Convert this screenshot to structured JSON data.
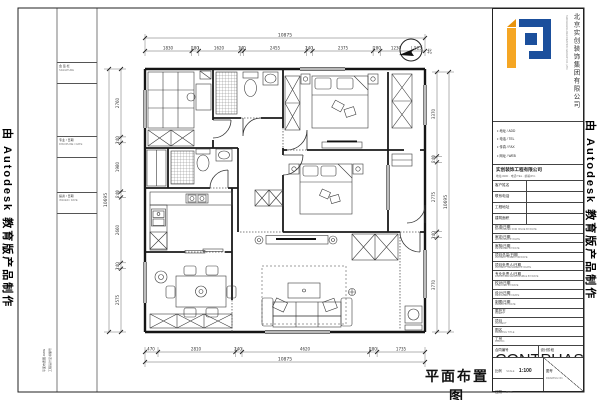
{
  "watermark": {
    "left": "由 Autodesk 教育版产品制作",
    "right": "由 Autodesk 教育版产品制作"
  },
  "plan": {
    "drawing_title": "平面布置图",
    "north_label": "北"
  },
  "dims": {
    "top": {
      "total": "10875",
      "parts": [
        "1830",
        "280",
        "1620",
        "140",
        "2455",
        "240",
        "2375",
        "280",
        "1230",
        "525"
      ]
    },
    "bottom": {
      "total": "10875",
      "parts": [
        "470",
        "2810",
        "240",
        "4620",
        "280",
        "1735"
      ]
    },
    "left": {
      "total": "10695",
      "parts": [
        "2760",
        "240",
        "1980",
        "240",
        "2660",
        "240",
        "2575"
      ]
    },
    "right": {
      "total": "10695",
      "parts": [
        "3370",
        "240",
        "2775",
        "240",
        "3770"
      ]
    }
  },
  "side_strip": {
    "cells": [
      {
        "line1": "会 签 栏",
        "line2": "SIGNATURE"
      },
      {
        "line1": "专业 / 日期",
        "line2": "DISCIPLINE / DATE"
      },
      {
        "line1": "提资 / 日期",
        "line2": "ISSUED / DATE"
      }
    ],
    "cert": "工程设计证书编号",
    "file": "平面布置图.DWG"
  },
  "title_block": {
    "brand": {
      "vertical_name": "北京实创装饰集团有限公司",
      "vertical_sub": "SHICHUANG DECORATION GROUP CO.,LTD."
    },
    "contacts": [
      {
        "text": "地址 / ADD"
      },
      {
        "text": "电话 / TEL"
      },
      {
        "text": "传真 / FAX"
      },
      {
        "text": "网址 / WEB"
      }
    ],
    "company": {
      "name": "实创装饰工程有限公司",
      "address": "地址/ADD · 电话/TEL · 邮编/P.C."
    },
    "info_rows": [
      {
        "label": "客户姓名"
      },
      {
        "label": "联系电话"
      },
      {
        "label": "工程地址"
      },
      {
        "label": "建筑面积"
      }
    ],
    "sign_rows": [
      {
        "cn": "批准/日期",
        "en": "AUTHORIZED FOR ISSUE BY/DATE"
      },
      {
        "cn": "审定/日期",
        "en": "APPROVED BY/DATE"
      },
      {
        "cn": "审核/日期",
        "en": "REVIEWED BY/DATE"
      },
      {
        "cn": "项目总监/日期",
        "en": "PROJECT DIRECTOR/DATE"
      },
      {
        "cn": "项目负责人/日期",
        "en": "PROJECT MANAGER BY/DATE"
      },
      {
        "cn": "专业负责人/日期",
        "en": "DISCIPLINE RESPONSIBLE BY/DATE"
      },
      {
        "cn": "校对/日期",
        "en": "CHECKED BY/DATE"
      },
      {
        "cn": "设计/日期",
        "en": "DESIGNED BY/DATE"
      },
      {
        "cn": "制图/日期",
        "en": "DRAWN BY/DATE"
      },
      {
        "cn": "委托方",
        "en": "CLIENT"
      },
      {
        "cn": "项目",
        "en": "PROJECT"
      },
      {
        "cn": "图名",
        "en": "DRAWING TITLE"
      },
      {
        "cn": "工号",
        "en": "JOB NO."
      }
    ],
    "phase": {
      "left_cn": "合同编号",
      "left_en": "CONTRACT NO.",
      "right_cn": "设计阶段",
      "right_en": "PHASE"
    },
    "scale": {
      "cn": "比例",
      "en": "SCALE",
      "value": "1:100"
    },
    "drawing_no": {
      "cn": "图号",
      "en": "DRAWING NO."
    },
    "date": {
      "cn": "日期",
      "en": "DATE"
    }
  }
}
